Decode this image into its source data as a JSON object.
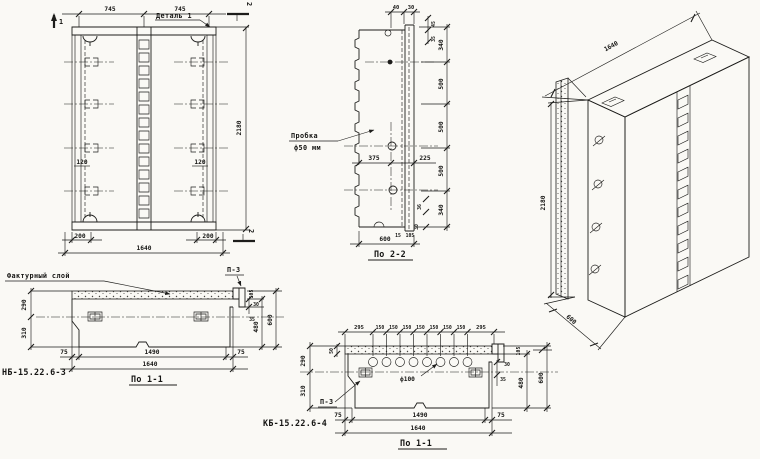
{
  "sheet": {
    "background": "#faf9f5",
    "ink": "#1d1d1b"
  },
  "front_view": {
    "dim_top_left": "745",
    "dim_top_right": "745",
    "detail_callout": "Деталь 1",
    "cut_mark_1": "1",
    "cut_mark_2_top": "2",
    "cut_mark_2_bottom": "2",
    "dim_height": "2180",
    "dim_120_left": "120",
    "dim_120_right": "120",
    "dim_200_left": "200",
    "dim_200_right": "200",
    "dim_width": "1640"
  },
  "section_2_2": {
    "title": "По 2-2",
    "plug_callout_line1": "Пробка",
    "plug_callout_line2": "ф50 мм",
    "top_dims": [
      "40",
      "30"
    ],
    "right_small_dims": [
      "45",
      "35"
    ],
    "height_dims": [
      "340",
      "500",
      "500",
      "500",
      "340"
    ],
    "hole_offset_dims": [
      "375",
      "225"
    ],
    "bottom_small_dims": [
      "36",
      "30",
      "15",
      "105"
    ],
    "dim_width": "600"
  },
  "isometric_view": {
    "dim_length": "1640",
    "dim_height": "2180",
    "dim_depth": "600"
  },
  "section_1_1_left": {
    "panel_mark": "НБ-15.22.6-3",
    "title": "По 1-1",
    "layer_callout": "Фактурный слой",
    "plate_callout": "П-3",
    "thickness_dims": [
      "290",
      "310"
    ],
    "right_small_dims": [
      "30",
      "35",
      "105"
    ],
    "right_dims": [
      "480",
      "600"
    ],
    "bottom_dims": [
      "75",
      "1490",
      "75"
    ],
    "dim_width": "1640"
  },
  "section_1_1_right": {
    "panel_mark": "КБ-15.22.6-4",
    "title": "По 1-1",
    "plate_callout": "П-3",
    "hole_callout": "ф100",
    "top_dims": [
      "295",
      "150",
      "150",
      "150",
      "150",
      "150",
      "150",
      "150",
      "295"
    ],
    "facing_dim": "50",
    "thickness_dims": [
      "290",
      "310"
    ],
    "right_small_dims": [
      "30",
      "35",
      "105"
    ],
    "right_dims": [
      "480",
      "600"
    ],
    "bottom_dims": [
      "75",
      "1490",
      "75"
    ],
    "dim_width": "1640"
  }
}
